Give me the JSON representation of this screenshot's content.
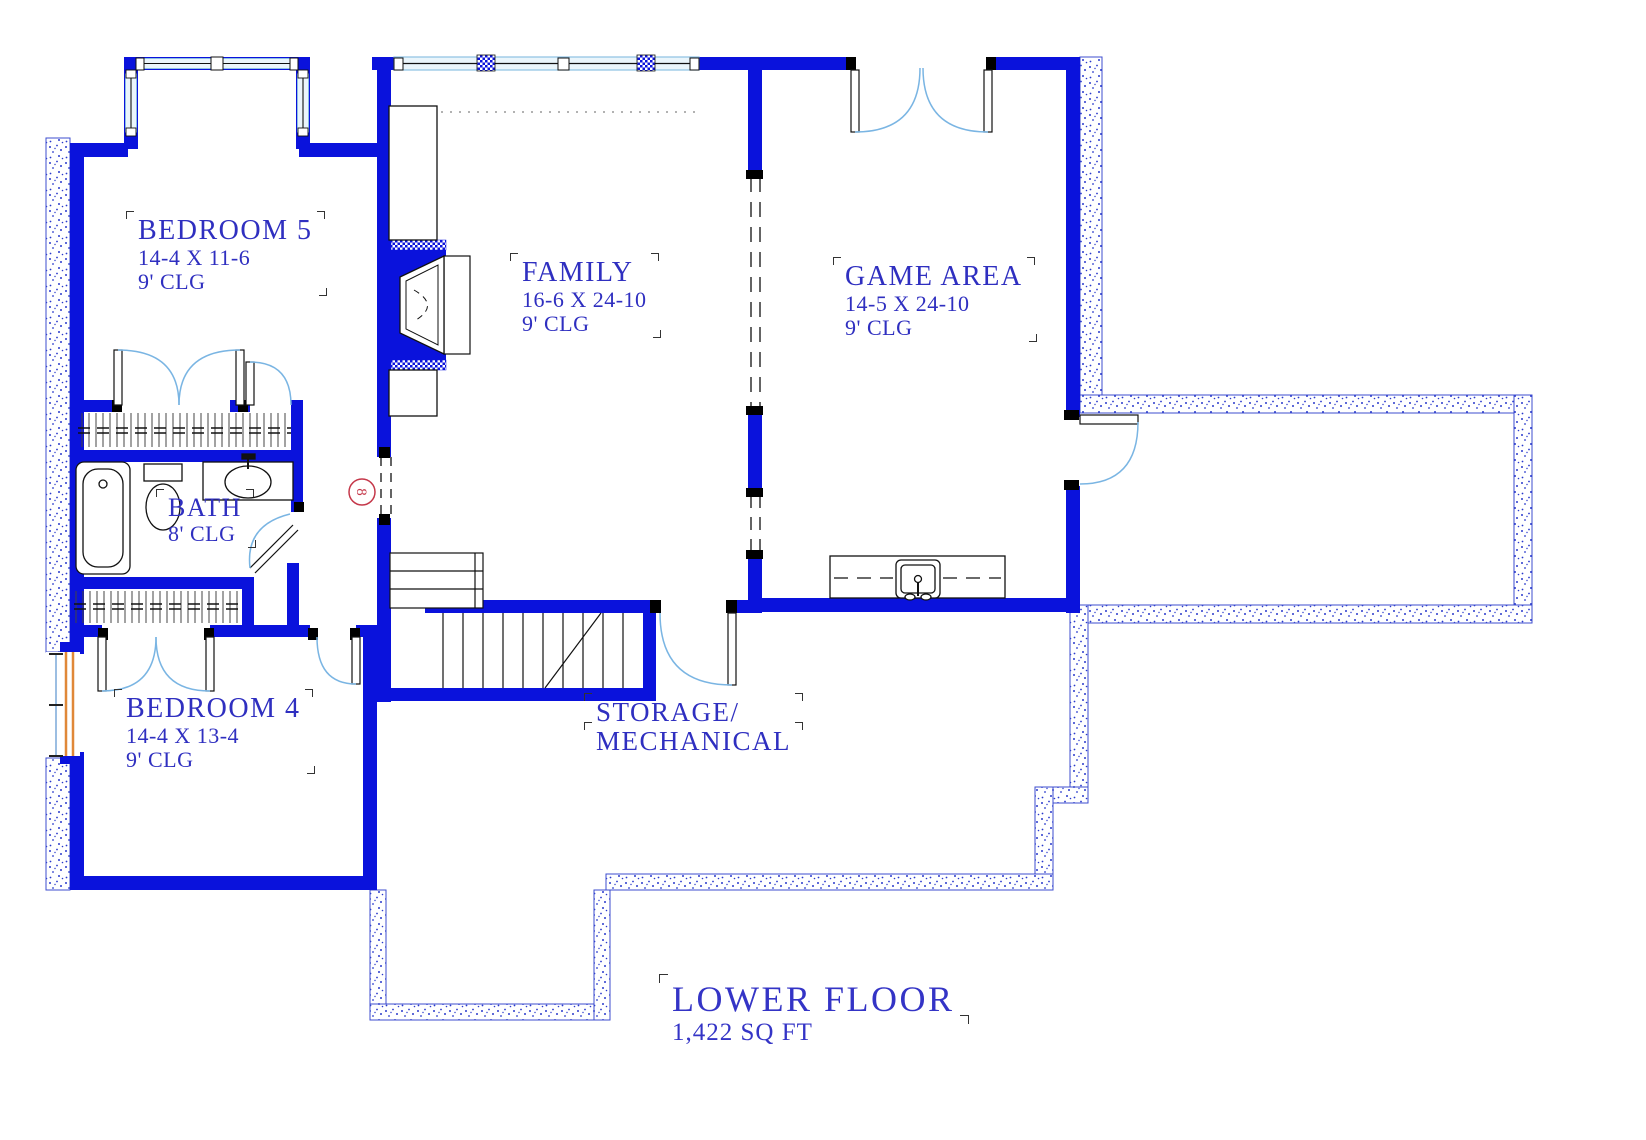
{
  "title": {
    "name": "LOWER FLOOR",
    "area": "1,422 SQ FT"
  },
  "rooms": [
    {
      "id": "bedroom-5",
      "name": "BEDROOM 5",
      "dims": "14-4 X 11-6",
      "ceiling": "9' CLG"
    },
    {
      "id": "family",
      "name": "FAMILY",
      "dims": "16-6 X 24-10",
      "ceiling": "9' CLG"
    },
    {
      "id": "game-area",
      "name": "GAME AREA",
      "dims": "14-5 X 24-10",
      "ceiling": "9' CLG"
    },
    {
      "id": "bath",
      "name": "BATH",
      "ceiling": "8' CLG"
    },
    {
      "id": "bedroom-4",
      "name": "BEDROOM 4",
      "dims": "14-4 X 13-4",
      "ceiling": "9' CLG"
    },
    {
      "id": "storage-mechanical",
      "name": "STORAGE/",
      "name_line2": "MECHANICAL"
    }
  ],
  "keynote": {
    "number": "8"
  },
  "colors": {
    "wall_blue": "#0a12dc",
    "label_text": "#2f2fc0",
    "door_arc_blue": "#7ab5e3",
    "keynote_red": "#c5384a",
    "window_orange": "#e08838",
    "foundation_dot": "#2a3acc"
  }
}
